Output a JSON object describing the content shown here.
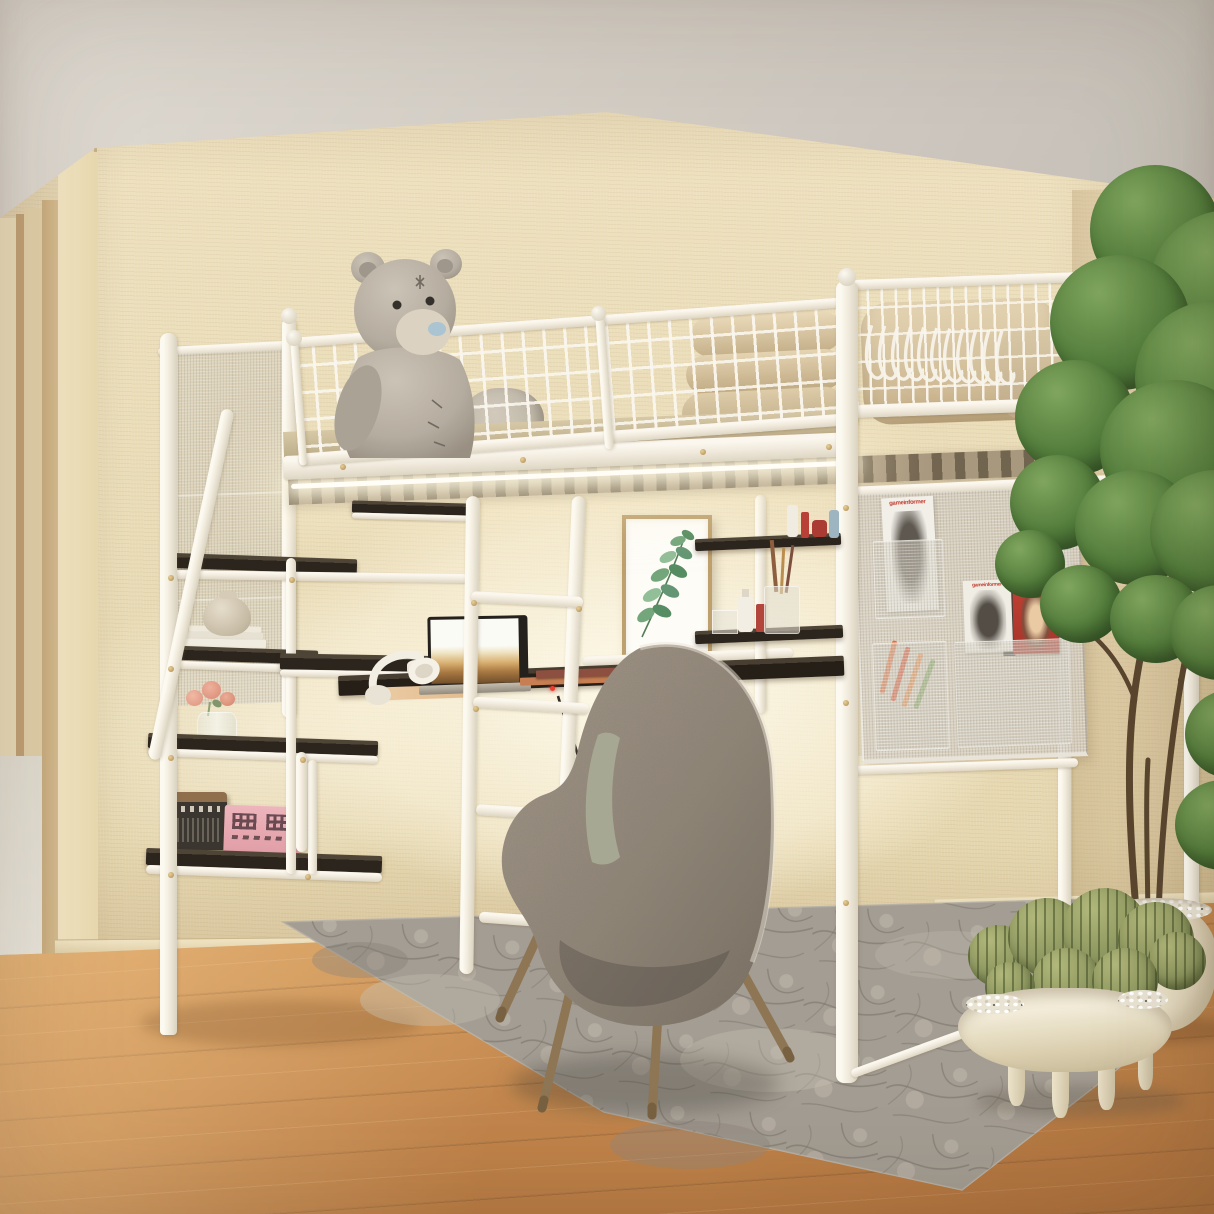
{
  "meta": {
    "description": "Product lifestyle photo: white metal loft bed with guardrails, built-in storage staircase, under-bed desk with laptop, lounge chair, side mesh organizer panel and plants in a beige bedroom"
  },
  "magazines": {
    "top_pocket": "gameinformer",
    "right_pocket_left": "gameinformer",
    "right_pocket_right": "Men's Health"
  },
  "palette": {
    "wall": "#e8dab5",
    "ceiling": "#d3cdc5",
    "floor_wood": "#c9894e",
    "rug": "#a7a198",
    "bed_frame_white": "#f4f0e7",
    "shelf_dark": "#2c241d",
    "bedding_beige": "#d9c8a6",
    "chair_fabric": "#8f8477",
    "cushion_sage": "#a6a892",
    "plant_green": "#4d7836",
    "pot_cream": "#ece3cc",
    "box_pink": "#e8a9b2",
    "magazine_red": "#c23b30"
  },
  "objects": [
    "loft-bed",
    "front-guardrail",
    "right-guardrail",
    "hangers",
    "teddy-bear",
    "plush-toy",
    "folded-bedding",
    "led-strip",
    "storage-staircase",
    "handrail",
    "vase",
    "books",
    "flower-vase",
    "roses",
    "radio",
    "pink-box",
    "desk",
    "laptop",
    "headphones",
    "mug",
    "papers",
    "power-cord",
    "wall-art-eucalyptus",
    "floating-shelves",
    "cosmetics",
    "brush-cup",
    "mesh-organizer-panel",
    "marker-pens",
    "lounge-chair",
    "area-rug",
    "potted-tree",
    "cactus-bowl",
    "doorway",
    "wood-floor"
  ]
}
